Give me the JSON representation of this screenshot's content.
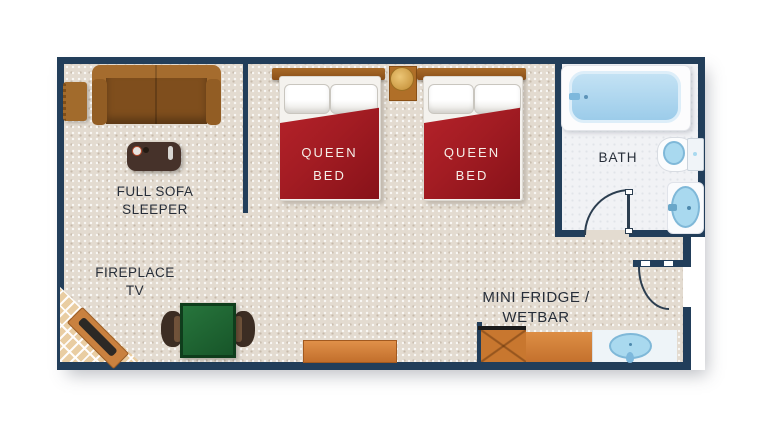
{
  "plan": {
    "type": "hotel-room-floorplan",
    "labels": {
      "sofa": {
        "line1": "FULL SOFA",
        "line2": "SLEEPER"
      },
      "fireplace": {
        "line1": "FIREPLACE",
        "line2": "TV"
      },
      "bed1": {
        "line1": "QUEEN",
        "line2": "BED"
      },
      "bed2": {
        "line1": "QUEEN",
        "line2": "BED"
      },
      "bath": {
        "text": "BATH"
      },
      "wetbar": {
        "line1": "MINI FRIDGE /",
        "line2": "WETBAR"
      }
    },
    "colors": {
      "wall": "#223e5a",
      "carpet": "#e3dbd0",
      "bath_floor": "#f1f2f5",
      "bed_blanket_red": "#a31c23",
      "sofa_brown": "#9a6226",
      "counter_orange": "#cf7d39",
      "table_green": "#1d6a34",
      "fixture_blue": "#a9d9ef",
      "fireplace_brick": "#e9cda2",
      "label_dark": "#272e39",
      "label_light": "#f6efe9"
    },
    "icons": {
      "sofa-icon": "css-shape",
      "ottoman-icon": "css-shape",
      "coffee-table-icon": "css-shape",
      "queen-bed-icon": "css-shape",
      "pillow-icon": "css-shape",
      "nightstand-icon": "css-shape",
      "lamp-icon": "css-circle",
      "bathtub-icon": "css-shape",
      "toilet-icon": "css-shape",
      "pedestal-sink-icon": "css-shape",
      "door-swing-icon": "css-arc",
      "fireplace-icon": "css-shape",
      "tv-icon": "css-shape",
      "dining-table-icon": "css-shape",
      "chair-icon": "css-shape",
      "dresser-icon": "css-shape",
      "mini-fridge-icon": "css-shape",
      "wetbar-sink-icon": "css-shape"
    }
  }
}
